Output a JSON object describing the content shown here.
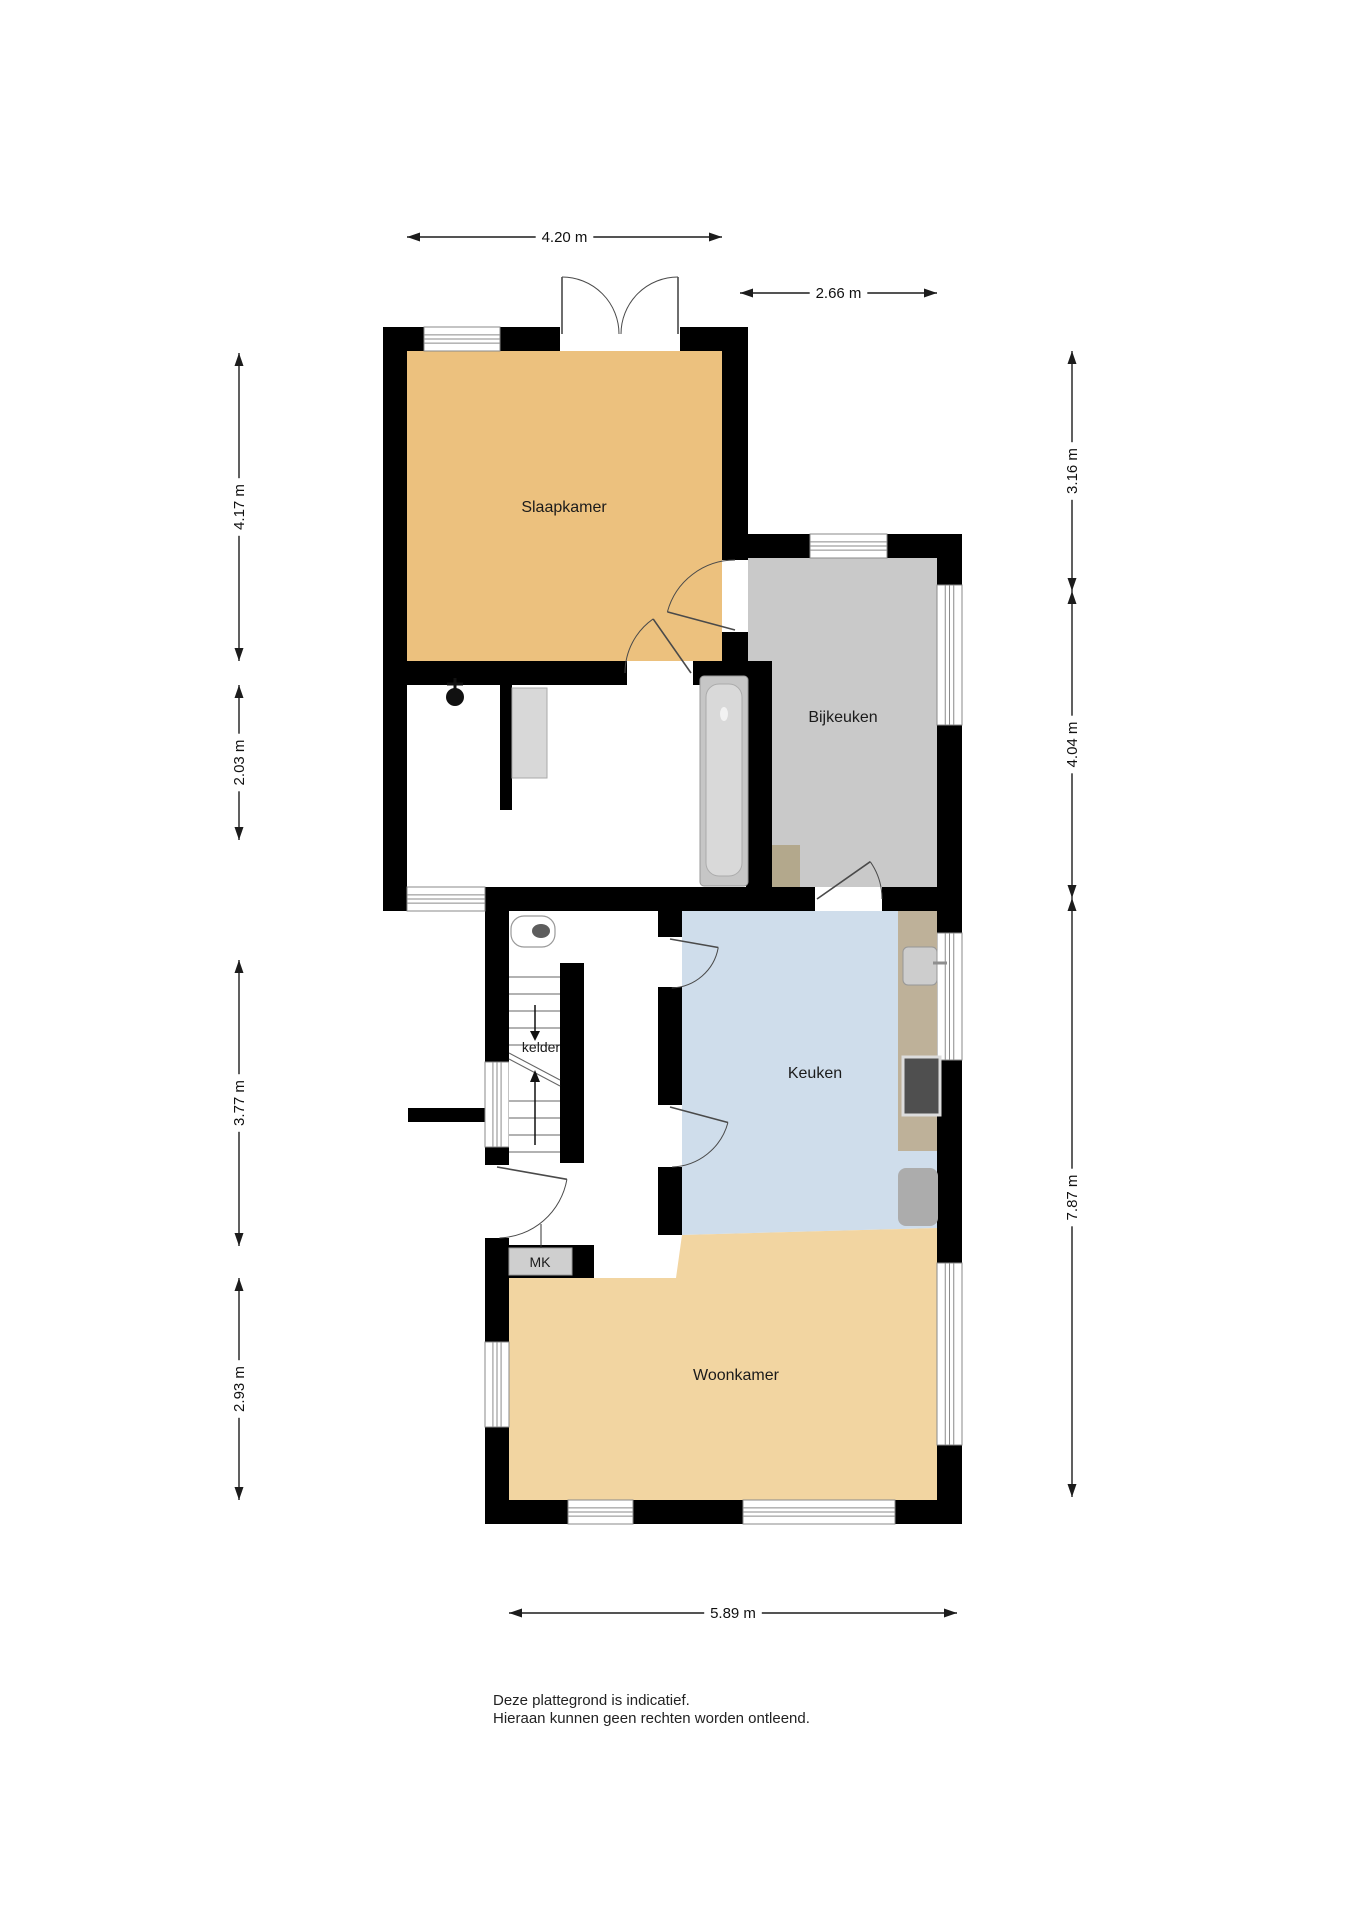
{
  "canvas": {
    "width": 1358,
    "height": 1920,
    "background": "#ffffff"
  },
  "colors": {
    "wall": "#000000",
    "slaapkamer": "#ECC17E",
    "woonkamer": "#F2D5A1",
    "keuken": "#CFDDEB",
    "bijkeuken": "#C9C9C9",
    "bathroom": "#FFFFFF",
    "hall": "#FFFFFF",
    "counter": "#BEB199",
    "step": "#B3A88C",
    "fixture_gray": "#CFCFCF",
    "stove": "#4F4F4F",
    "dim_line": "#1c1c1c",
    "label_text": "#1b1b1b"
  },
  "rooms": [
    {
      "key": "slaapkamer",
      "label": "Slaapkamer",
      "color_key": "slaapkamer",
      "rect": [
        407,
        351,
        315,
        310
      ],
      "label_x": 564,
      "label_y": 512,
      "label_size": 16
    },
    {
      "key": "bathroom",
      "label": "",
      "color_key": "bathroom",
      "rect": [
        407,
        685,
        341,
        202
      ],
      "label_x": 0,
      "label_y": 0,
      "label_size": 0
    },
    {
      "key": "bijkeuken",
      "label": "Bijkeuken",
      "color_key": "bijkeuken",
      "rect": [
        746,
        558,
        191,
        329
      ],
      "label_x": 843,
      "label_y": 722,
      "label_size": 16
    },
    {
      "key": "hall",
      "label": "",
      "color_key": "hall",
      "rect": [
        509,
        911,
        173,
        367
      ],
      "label_x": 0,
      "label_y": 0,
      "label_size": 0
    },
    {
      "key": "keuken",
      "label": "Keuken",
      "color_key": "keuken",
      "poly": [
        [
          682,
          911
        ],
        [
          937,
          911
        ],
        [
          937,
          1228
        ],
        [
          682,
          1235
        ]
      ],
      "label_x": 815,
      "label_y": 1078,
      "label_size": 16
    },
    {
      "key": "woonkamer",
      "label": "Woonkamer",
      "color_key": "woonkamer",
      "poly": [
        [
          509,
          1278
        ],
        [
          676,
          1278
        ],
        [
          682,
          1235
        ],
        [
          937,
          1228
        ],
        [
          937,
          1500
        ],
        [
          509,
          1500
        ]
      ],
      "label_x": 736,
      "label_y": 1380,
      "label_size": 16
    }
  ],
  "walls": [
    [
      383,
      327,
      363,
      24
    ],
    [
      383,
      327,
      24,
      584
    ],
    [
      722,
      327,
      26,
      358
    ],
    [
      722,
      534,
      240,
      24
    ],
    [
      937,
      534,
      25,
      990
    ],
    [
      407,
      661,
      341,
      24
    ],
    [
      746,
      661,
      26,
      250
    ],
    [
      383,
      887,
      579,
      24
    ],
    [
      485,
      911,
      24,
      613
    ],
    [
      485,
      1500,
      477,
      24
    ],
    [
      658,
      911,
      24,
      324
    ],
    [
      560,
      963,
      24,
      200
    ],
    [
      500,
      685,
      12,
      125
    ],
    [
      485,
      1245,
      109,
      33
    ],
    [
      408,
      1108,
      77,
      14
    ]
  ],
  "windows": [
    {
      "rect": [
        424,
        327,
        76,
        24
      ],
      "orient": "h"
    },
    {
      "rect": [
        810,
        534,
        77,
        24
      ],
      "orient": "h"
    },
    {
      "rect": [
        937,
        585,
        25,
        140
      ],
      "orient": "v"
    },
    {
      "rect": [
        937,
        933,
        25,
        127
      ],
      "orient": "v"
    },
    {
      "rect": [
        937,
        1263,
        25,
        182
      ],
      "orient": "v"
    },
    {
      "rect": [
        407,
        887,
        78,
        24
      ],
      "orient": "h"
    },
    {
      "rect": [
        485,
        1062,
        24,
        85
      ],
      "orient": "v"
    },
    {
      "rect": [
        485,
        1342,
        24,
        85
      ],
      "orient": "v"
    },
    {
      "rect": [
        568,
        1500,
        65,
        24
      ],
      "orient": "h"
    },
    {
      "rect": [
        743,
        1500,
        152,
        24
      ],
      "orient": "h"
    }
  ],
  "doors": [
    {
      "name": "french-door-left",
      "gap": [
        560,
        327,
        120,
        24
      ],
      "hinge": [
        562,
        334
      ],
      "r": 57,
      "leaf": -90,
      "arc_to": 0,
      "sweep": 1
    },
    {
      "name": "french-door-right",
      "gap": null,
      "hinge": [
        678,
        334
      ],
      "r": 57,
      "leaf": -90,
      "arc_to": 180,
      "sweep": 0
    },
    {
      "name": "door-slaap-bijkeuken",
      "gap": [
        722,
        560,
        26,
        72
      ],
      "hinge": [
        735,
        630
      ],
      "r": 70,
      "leaf": 195,
      "arc_to": 270,
      "sweep": 1
    },
    {
      "name": "door-slaap-bathroom",
      "gap": [
        627,
        661,
        66,
        24
      ],
      "hinge": [
        691,
        673
      ],
      "r": 66,
      "leaf": 235,
      "arc_to": 180,
      "sweep": 0
    },
    {
      "name": "door-bijkeuken",
      "gap": [
        815,
        887,
        67,
        24
      ],
      "hinge": [
        817,
        899
      ],
      "r": 65,
      "leaf": -35,
      "arc_to": 0,
      "sweep": 1
    },
    {
      "name": "door-keuken-boven",
      "gap": [
        658,
        937,
        24,
        50
      ],
      "hinge": [
        670,
        939
      ],
      "r": 49,
      "leaf": 10,
      "arc_to": 88,
      "sweep": 1
    },
    {
      "name": "door-keuken-onder",
      "gap": [
        658,
        1105,
        24,
        62
      ],
      "hinge": [
        670,
        1107
      ],
      "r": 60,
      "leaf": 15,
      "arc_to": 88,
      "sweep": 1
    },
    {
      "name": "front-door",
      "gap": [
        485,
        1165,
        24,
        73
      ],
      "hinge": [
        497,
        1167
      ],
      "r": 71,
      "leaf": 10,
      "arc_to": 88,
      "sweep": 1
    }
  ],
  "fixtures": [
    {
      "type": "shower",
      "x": 455,
      "y": 697
    },
    {
      "type": "cabinet",
      "rect": [
        512,
        688,
        35,
        90
      ]
    },
    {
      "type": "bathtub",
      "rect": [
        700,
        676,
        48,
        210
      ]
    },
    {
      "type": "toilet",
      "rect": [
        511,
        916,
        44,
        31
      ]
    },
    {
      "type": "step",
      "rect": [
        772,
        845,
        28,
        42
      ]
    },
    {
      "type": "counter",
      "rect": [
        898,
        911,
        39,
        240
      ]
    },
    {
      "type": "sink",
      "rect": [
        903,
        947,
        34,
        38
      ]
    },
    {
      "type": "stove",
      "rect": [
        903,
        1057,
        37,
        58
      ]
    },
    {
      "type": "appliance",
      "rect": [
        898,
        1168,
        40,
        58
      ]
    },
    {
      "type": "stairs",
      "rect": [
        509,
        963,
        51,
        200
      ]
    },
    {
      "type": "mk-box",
      "rect": [
        509,
        1248,
        63,
        27
      ]
    }
  ],
  "labels": [
    {
      "key": "kelder-label",
      "text": "kelder",
      "x": 541,
      "y": 1052,
      "size": 14
    },
    {
      "key": "mk-label",
      "text": "MK",
      "x": 540,
      "y": 1267,
      "size": 14
    }
  ],
  "dimensions": [
    {
      "label": "4.20 m",
      "axis": "h",
      "x1": 407,
      "x2": 722,
      "y": 237
    },
    {
      "label": "2.66 m",
      "axis": "h",
      "x1": 740,
      "x2": 937,
      "y": 293
    },
    {
      "label": "4.17 m",
      "axis": "v",
      "y1": 353,
      "y2": 661,
      "x": 239
    },
    {
      "label": "2.03 m",
      "axis": "v",
      "y1": 685,
      "y2": 840,
      "x": 239
    },
    {
      "label": "3.77 m",
      "axis": "v",
      "y1": 960,
      "y2": 1246,
      "x": 239
    },
    {
      "label": "2.93 m",
      "axis": "v",
      "y1": 1278,
      "y2": 1500,
      "x": 239
    },
    {
      "label": "3.16 m",
      "axis": "v",
      "y1": 351,
      "y2": 591,
      "x": 1072
    },
    {
      "label": "4.04 m",
      "axis": "v",
      "y1": 591,
      "y2": 898,
      "x": 1072
    },
    {
      "label": "7.87 m",
      "axis": "v",
      "y1": 898,
      "y2": 1497,
      "x": 1072
    },
    {
      "label": "5.89 m",
      "axis": "h",
      "x1": 509,
      "x2": 957,
      "y": 1613
    }
  ],
  "disclaimer": {
    "line1": "Deze plattegrond is indicatief.",
    "line2": "Hieraan kunnen geen rechten worden ontleend."
  }
}
